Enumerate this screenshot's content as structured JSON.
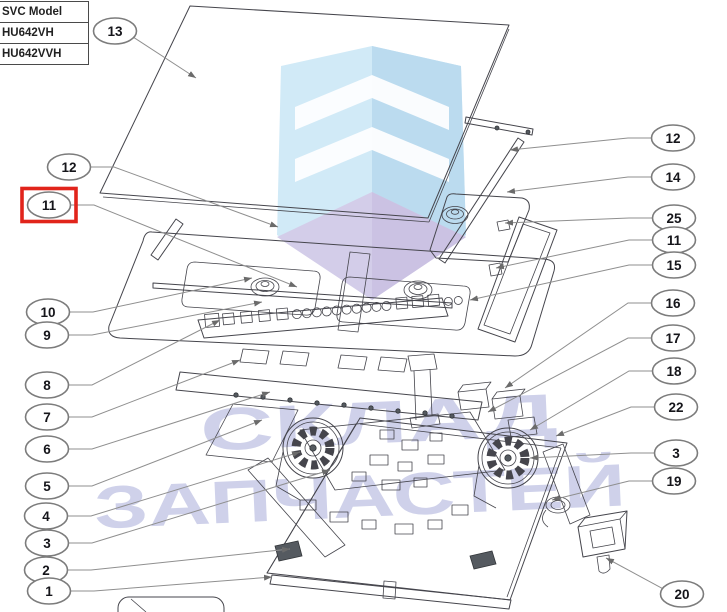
{
  "model_table": {
    "rows": [
      "SVC Model",
      "HU642VH",
      "HU642VVH"
    ]
  },
  "watermark": {
    "line1": "СКЛАД",
    "line2": "ЗАПЧАСТЕЙ",
    "text_color": "#7b82c6",
    "logo_colors": {
      "left_face": "#c6e5f5",
      "right_face": "#abd3ec",
      "floor_left": "#c9c1e4",
      "floor_right": "#beb3dc",
      "chevron": "#ffffff"
    }
  },
  "highlight": {
    "part": "11",
    "color": "#e1241b"
  },
  "callouts": {
    "left": [
      {
        "num": "13",
        "x": 115,
        "y": 31,
        "tx": 196,
        "ty": 78,
        "direct": true
      },
      {
        "num": "12",
        "x": 69,
        "y": 167,
        "tx": 278,
        "ty": 227
      },
      {
        "num": "11",
        "x": 49,
        "y": 205,
        "tx": 297,
        "ty": 287,
        "highlight": true
      },
      {
        "num": "10",
        "x": 48,
        "y": 312,
        "tx": 252,
        "ty": 278
      },
      {
        "num": "9",
        "x": 47,
        "y": 335,
        "tx": 262,
        "ty": 302
      },
      {
        "num": "8",
        "x": 47,
        "y": 385,
        "tx": 220,
        "ty": 320
      },
      {
        "num": "7",
        "x": 47,
        "y": 417,
        "tx": 240,
        "ty": 360
      },
      {
        "num": "6",
        "x": 47,
        "y": 449,
        "tx": 270,
        "ty": 392
      },
      {
        "num": "5",
        "x": 47,
        "y": 486,
        "tx": 262,
        "ty": 420
      },
      {
        "num": "4",
        "x": 46,
        "y": 516,
        "tx": 300,
        "ty": 452
      },
      {
        "num": "3",
        "x": 47,
        "y": 543,
        "tx": 330,
        "ty": 470
      },
      {
        "num": "2",
        "x": 46,
        "y": 570,
        "tx": 290,
        "ty": 549
      },
      {
        "num": "1",
        "x": 49,
        "y": 591,
        "tx": 272,
        "ty": 577
      }
    ],
    "right": [
      {
        "num": "12",
        "x": 673,
        "y": 138,
        "tx": 510,
        "ty": 150
      },
      {
        "num": "14",
        "x": 673,
        "y": 177,
        "tx": 507,
        "ty": 192
      },
      {
        "num": "25",
        "x": 674,
        "y": 218,
        "tx": 505,
        "ty": 223
      },
      {
        "num": "11",
        "x": 674,
        "y": 240,
        "tx": 496,
        "ty": 268
      },
      {
        "num": "15",
        "x": 674,
        "y": 265,
        "tx": 470,
        "ty": 300
      },
      {
        "num": "16",
        "x": 673,
        "y": 303,
        "tx": 505,
        "ty": 388
      },
      {
        "num": "17",
        "x": 673,
        "y": 338,
        "tx": 488,
        "ty": 412
      },
      {
        "num": "18",
        "x": 674,
        "y": 371,
        "tx": 530,
        "ty": 430
      },
      {
        "num": "22",
        "x": 676,
        "y": 407,
        "tx": 556,
        "ty": 436
      },
      {
        "num": "3",
        "x": 676,
        "y": 453,
        "tx": 530,
        "ty": 458
      },
      {
        "num": "19",
        "x": 674,
        "y": 481,
        "tx": 552,
        "ty": 500
      },
      {
        "num": "20",
        "x": 682,
        "y": 594,
        "tx": 606,
        "ty": 558,
        "direct": true
      }
    ]
  }
}
